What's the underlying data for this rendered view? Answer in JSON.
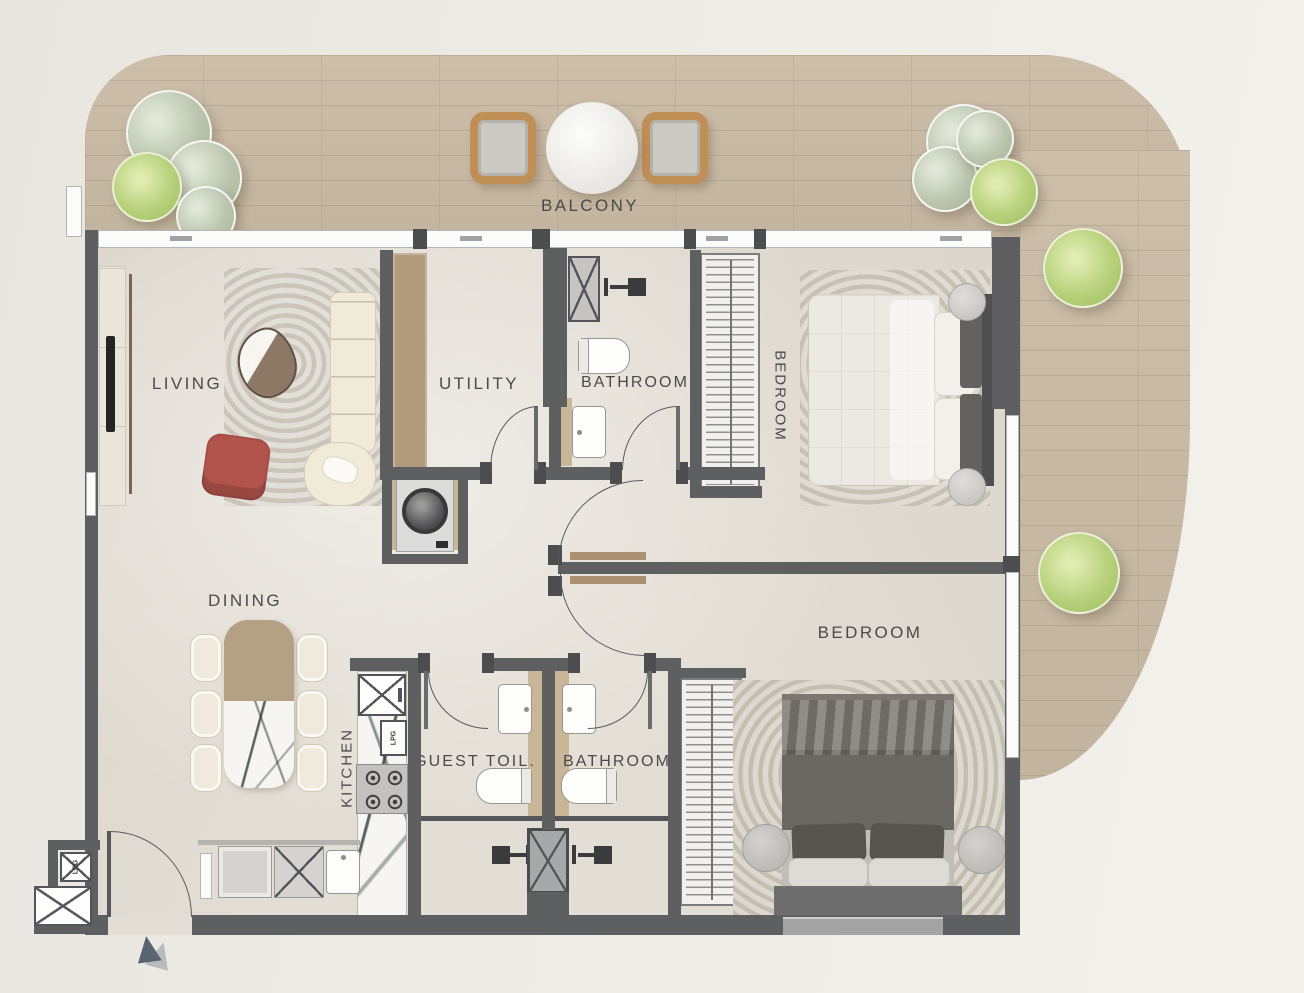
{
  "floorplan": {
    "rooms": {
      "balcony": {
        "label": "BALCONY"
      },
      "living": {
        "label": "LIVING"
      },
      "utility": {
        "label": "UTILITY"
      },
      "bathroom_top": {
        "label": "BATHROOM"
      },
      "bedroom_top": {
        "label": "BEDROOM"
      },
      "dining": {
        "label": "DINING"
      },
      "bedroom_bottom": {
        "label": "BEDROOM"
      },
      "kitchen": {
        "label": "KITCHEN"
      },
      "guest_toilet": {
        "label": "GUEST TOIL."
      },
      "bathroom_bottom": {
        "label": "BATHROOM"
      }
    },
    "markings": {
      "lpg_kitchen": "LPG",
      "lpg_meter": "LPG"
    },
    "colors": {
      "wall": "#5e5f61",
      "deck_wood": "#c9baa4",
      "floor": "#e3ded5",
      "accent_chair_red": "#b3544c",
      "plant_sage": "#bcc6af",
      "plant_lime": "#b8d17c",
      "door_leaf_wood": "#ab9171",
      "label_text": "#4a4a4a"
    }
  }
}
